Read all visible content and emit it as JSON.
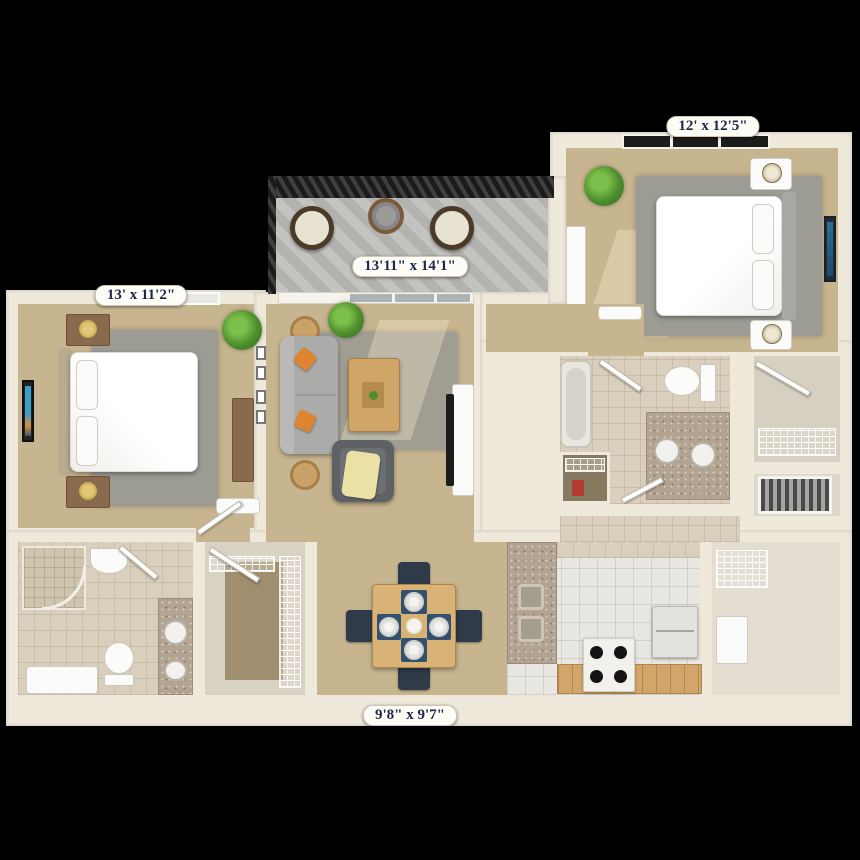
{
  "title": "apartment-3d-floor-plan",
  "labels": {
    "bedroom2": "12' x 12'5\"",
    "bedroom1": "13' x 11'2\"",
    "living": "13'11\" x 14'1\"",
    "dining": "9'8\" x 9'7\""
  },
  "colors": {
    "background": "#000000",
    "wall": "#efe9dc",
    "carpet": "#c7b590",
    "rug": "#9c9c94",
    "bathroom_tile": "#d9cfbc",
    "kitchen_tile": "#e9e7e1",
    "granite_counter": "#b3a391",
    "wood": "#d2a66a",
    "sofa_gray": "#ababa9",
    "accent_orange": "#df8430",
    "throw_yellow": "#ece1a4",
    "chair_navy": "#2f3b49",
    "balcony_floor": "#b2b3af",
    "railing": "#222222",
    "label_text": "#1d2646",
    "label_background": "#fdfcf7"
  }
}
